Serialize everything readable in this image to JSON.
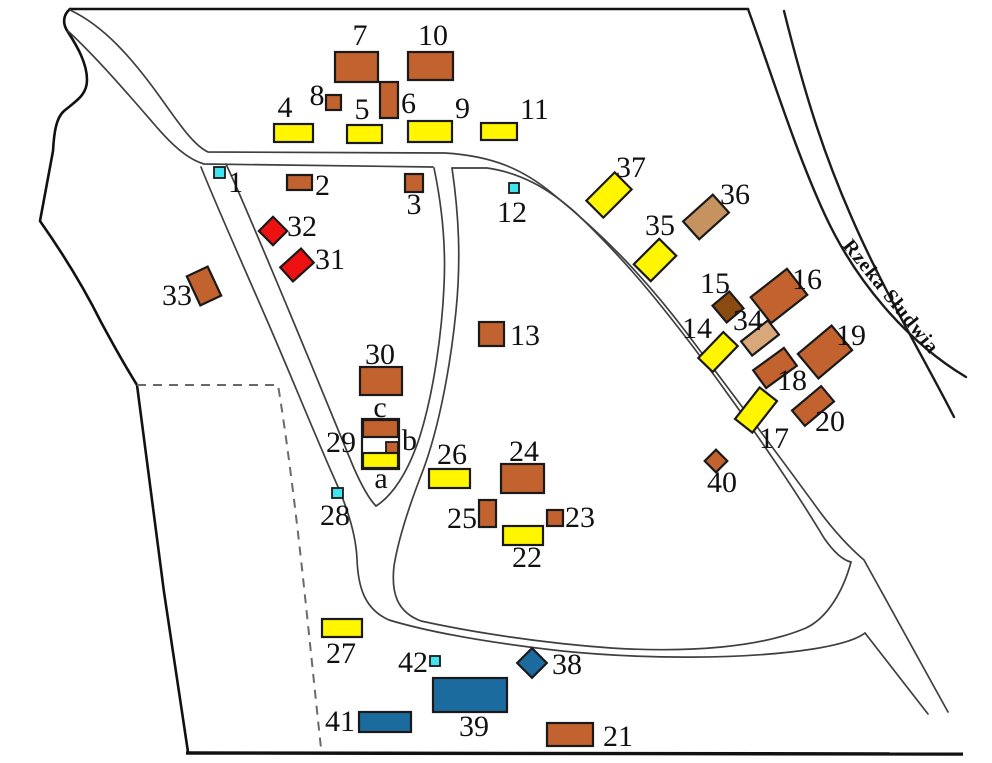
{
  "river": {
    "label": "Rzeka Słudwia"
  },
  "palette": {
    "sienna": "#C1622F",
    "yellow": "#FFF600",
    "red": "#EE1111",
    "tan_dark": "#C6925F",
    "tan_light": "#D9A87A",
    "dark_brown": "#8B4A10",
    "blue": "#1C6B9F",
    "cyan": "#3FE4EE",
    "white": "#FFFFFF",
    "outline": "#1a1a1a",
    "road": "#3f3f3f"
  },
  "buildings": [
    {
      "id": "29-outline",
      "color": "white",
      "cx": 380.5,
      "cy": 444,
      "w": 37,
      "h": 50,
      "rot": 0
    },
    {
      "id": "1",
      "color": "cyan",
      "cx": 219.5,
      "cy": 172.5,
      "w": 11,
      "h": 11,
      "rot": 0
    },
    {
      "id": "2",
      "color": "sienna",
      "cx": 299.5,
      "cy": 182.5,
      "w": 25,
      "h": 15,
      "rot": 0
    },
    {
      "id": "3",
      "color": "sienna",
      "cx": 414,
      "cy": 183,
      "w": 18,
      "h": 18,
      "rot": 0
    },
    {
      "id": "4",
      "color": "yellow",
      "cx": 293.5,
      "cy": 133,
      "w": 39,
      "h": 18,
      "rot": 0
    },
    {
      "id": "5",
      "color": "yellow",
      "cx": 364.5,
      "cy": 134,
      "w": 35,
      "h": 18,
      "rot": 0
    },
    {
      "id": "6",
      "color": "sienna",
      "cx": 389,
      "cy": 100,
      "w": 18,
      "h": 36,
      "rot": 0
    },
    {
      "id": "7",
      "color": "sienna",
      "cx": 356.5,
      "cy": 67,
      "w": 43,
      "h": 30,
      "rot": 0
    },
    {
      "id": "8",
      "color": "sienna",
      "cx": 333.5,
      "cy": 102.5,
      "w": 15,
      "h": 15,
      "rot": 0
    },
    {
      "id": "9",
      "color": "yellow",
      "cx": 430,
      "cy": 131.5,
      "w": 44,
      "h": 21,
      "rot": 0
    },
    {
      "id": "10",
      "color": "sienna",
      "cx": 430.5,
      "cy": 66,
      "w": 45,
      "h": 28,
      "rot": 0
    },
    {
      "id": "11",
      "color": "yellow",
      "cx": 499,
      "cy": 131.5,
      "w": 36,
      "h": 17,
      "rot": 0
    },
    {
      "id": "12",
      "color": "cyan",
      "cx": 514,
      "cy": 188,
      "w": 10,
      "h": 10,
      "rot": 0
    },
    {
      "id": "13",
      "color": "sienna",
      "cx": 491.5,
      "cy": 334,
      "w": 25,
      "h": 24,
      "rot": 0
    },
    {
      "id": "14",
      "color": "yellow",
      "cx": 718,
      "cy": 352,
      "w": 36,
      "h": 20,
      "rot": -46
    },
    {
      "id": "15",
      "color": "dark_brown",
      "cx": 728,
      "cy": 307,
      "w": 22,
      "h": 22,
      "rot": -40
    },
    {
      "id": "16",
      "color": "sienna",
      "cx": 779,
      "cy": 296,
      "w": 46,
      "h": 33,
      "rot": -38
    },
    {
      "id": "17",
      "color": "yellow",
      "cx": 756,
      "cy": 410,
      "w": 40,
      "h": 22,
      "rot": -52
    },
    {
      "id": "18",
      "color": "sienna",
      "cx": 775,
      "cy": 368,
      "w": 38,
      "h": 22,
      "rot": -36
    },
    {
      "id": "19",
      "color": "sienna",
      "cx": 825,
      "cy": 352,
      "w": 44,
      "h": 32,
      "rot": -40
    },
    {
      "id": "20",
      "color": "sienna",
      "cx": 813,
      "cy": 406,
      "w": 38,
      "h": 20,
      "rot": -40
    },
    {
      "id": "21",
      "color": "sienna",
      "cx": 570,
      "cy": 734.5,
      "w": 46,
      "h": 23,
      "rot": 0
    },
    {
      "id": "22",
      "color": "yellow",
      "cx": 523,
      "cy": 535.5,
      "w": 40,
      "h": 19,
      "rot": 0
    },
    {
      "id": "23",
      "color": "sienna",
      "cx": 555,
      "cy": 518,
      "w": 16,
      "h": 16,
      "rot": 0
    },
    {
      "id": "24",
      "color": "sienna",
      "cx": 522.5,
      "cy": 478.5,
      "w": 43,
      "h": 29,
      "rot": 0
    },
    {
      "id": "25",
      "color": "sienna",
      "cx": 487.5,
      "cy": 513.5,
      "w": 17,
      "h": 27,
      "rot": 0
    },
    {
      "id": "26",
      "color": "yellow",
      "cx": 449.5,
      "cy": 478.5,
      "w": 41,
      "h": 19,
      "rot": 0
    },
    {
      "id": "27",
      "color": "yellow",
      "cx": 342,
      "cy": 628,
      "w": 40,
      "h": 18,
      "rot": 0
    },
    {
      "id": "28",
      "color": "cyan",
      "cx": 337.5,
      "cy": 493,
      "w": 11,
      "h": 10,
      "rot": 0
    },
    {
      "id": "29-c",
      "color": "sienna",
      "cx": 380.5,
      "cy": 428.5,
      "w": 35,
      "h": 17,
      "rot": 0
    },
    {
      "id": "29-b",
      "color": "sienna",
      "cx": 392,
      "cy": 447.5,
      "w": 12,
      "h": 11,
      "rot": 0
    },
    {
      "id": "29-a",
      "color": "yellow",
      "cx": 380.5,
      "cy": 460.5,
      "w": 35,
      "h": 15,
      "rot": 0
    },
    {
      "id": "30",
      "color": "sienna",
      "cx": 381,
      "cy": 381,
      "w": 42,
      "h": 28,
      "rot": 0
    },
    {
      "id": "31",
      "color": "red",
      "cx": 297,
      "cy": 265,
      "w": 28,
      "h": 19,
      "rot": -42
    },
    {
      "id": "32",
      "color": "red",
      "cx": 273,
      "cy": 231,
      "w": 20,
      "h": 20,
      "rot": -45
    },
    {
      "id": "33",
      "color": "sienna",
      "cx": 204,
      "cy": 286,
      "w": 23,
      "h": 32,
      "rot": -25
    },
    {
      "id": "34",
      "color": "tan_light",
      "cx": 760,
      "cy": 338,
      "w": 34,
      "h": 18,
      "rot": -38
    },
    {
      "id": "35",
      "color": "yellow",
      "cx": 655,
      "cy": 260,
      "w": 36,
      "h": 24,
      "rot": -45
    },
    {
      "id": "36",
      "color": "tan_dark",
      "cx": 706,
      "cy": 217,
      "w": 40,
      "h": 24,
      "rot": -42
    },
    {
      "id": "37",
      "color": "yellow",
      "cx": 609,
      "cy": 195,
      "w": 40,
      "h": 24,
      "rot": -45
    },
    {
      "id": "38",
      "color": "blue",
      "cx": 532,
      "cy": 663,
      "w": 21,
      "h": 21,
      "rot": -45
    },
    {
      "id": "39",
      "color": "blue",
      "cx": 470,
      "cy": 695,
      "w": 74,
      "h": 34,
      "rot": 0
    },
    {
      "id": "40",
      "color": "sienna",
      "cx": 716,
      "cy": 461,
      "w": 16,
      "h": 16,
      "rot": -45
    },
    {
      "id": "41",
      "color": "blue",
      "cx": 385,
      "cy": 722,
      "w": 52,
      "h": 20,
      "rot": 0
    },
    {
      "id": "42",
      "color": "cyan",
      "cx": 435,
      "cy": 661,
      "w": 10,
      "h": 10,
      "rot": 0
    }
  ],
  "labels": [
    {
      "text": "1",
      "x": 228,
      "y": 192,
      "anchor": "start"
    },
    {
      "text": "2",
      "x": 315,
      "y": 195,
      "anchor": "start"
    },
    {
      "text": "3",
      "x": 414,
      "y": 214,
      "anchor": "middle"
    },
    {
      "text": "4",
      "x": 285,
      "y": 117,
      "anchor": "middle"
    },
    {
      "text": "5",
      "x": 362,
      "y": 119,
      "anchor": "middle"
    },
    {
      "text": "6",
      "x": 401,
      "y": 113,
      "anchor": "start"
    },
    {
      "text": "7",
      "x": 360,
      "y": 45,
      "anchor": "middle"
    },
    {
      "text": "8",
      "x": 317,
      "y": 105,
      "anchor": "middle"
    },
    {
      "text": "9",
      "x": 455,
      "y": 118,
      "anchor": "start"
    },
    {
      "text": "10",
      "x": 433,
      "y": 45,
      "anchor": "middle"
    },
    {
      "text": "11",
      "x": 520,
      "y": 119,
      "anchor": "start"
    },
    {
      "text": "12",
      "x": 512,
      "y": 222,
      "anchor": "middle"
    },
    {
      "text": "13",
      "x": 510,
      "y": 345,
      "anchor": "start"
    },
    {
      "text": "14",
      "x": 682,
      "y": 338,
      "anchor": "start"
    },
    {
      "text": "15",
      "x": 700,
      "y": 293,
      "anchor": "start"
    },
    {
      "text": "16",
      "x": 792,
      "y": 289,
      "anchor": "start"
    },
    {
      "text": "17",
      "x": 774,
      "y": 448,
      "anchor": "middle"
    },
    {
      "text": "18",
      "x": 792,
      "y": 390,
      "anchor": "middle"
    },
    {
      "text": "19",
      "x": 836,
      "y": 345,
      "anchor": "start"
    },
    {
      "text": "20",
      "x": 830,
      "y": 431,
      "anchor": "middle"
    },
    {
      "text": "21",
      "x": 603,
      "y": 746,
      "anchor": "start"
    },
    {
      "text": "22",
      "x": 527,
      "y": 567,
      "anchor": "middle"
    },
    {
      "text": "23",
      "x": 565,
      "y": 527,
      "anchor": "start"
    },
    {
      "text": "24",
      "x": 524,
      "y": 461,
      "anchor": "middle"
    },
    {
      "text": "25",
      "x": 477,
      "y": 528,
      "anchor": "end"
    },
    {
      "text": "26",
      "x": 452,
      "y": 464,
      "anchor": "middle"
    },
    {
      "text": "27",
      "x": 341,
      "y": 663,
      "anchor": "middle"
    },
    {
      "text": "28",
      "x": 335,
      "y": 525,
      "anchor": "middle"
    },
    {
      "text": "29",
      "x": 341,
      "y": 452,
      "anchor": "middle"
    },
    {
      "text": "c",
      "x": 380,
      "y": 417,
      "anchor": "middle"
    },
    {
      "text": "b",
      "x": 402,
      "y": 450,
      "anchor": "start"
    },
    {
      "text": "a",
      "x": 381,
      "y": 488,
      "anchor": "middle"
    },
    {
      "text": "30",
      "x": 380,
      "y": 364,
      "anchor": "middle"
    },
    {
      "text": "31",
      "x": 315,
      "y": 269,
      "anchor": "start"
    },
    {
      "text": "32",
      "x": 287,
      "y": 236,
      "anchor": "start"
    },
    {
      "text": "33",
      "x": 177,
      "y": 305,
      "anchor": "middle"
    },
    {
      "text": "34",
      "x": 748,
      "y": 330,
      "anchor": "middle"
    },
    {
      "text": "35",
      "x": 660,
      "y": 235,
      "anchor": "middle"
    },
    {
      "text": "36",
      "x": 735,
      "y": 204,
      "anchor": "middle"
    },
    {
      "text": "37",
      "x": 631,
      "y": 177,
      "anchor": "middle"
    },
    {
      "text": "38",
      "x": 552,
      "y": 674,
      "anchor": "start"
    },
    {
      "text": "39",
      "x": 474,
      "y": 736,
      "anchor": "middle"
    },
    {
      "text": "40",
      "x": 722,
      "y": 492,
      "anchor": "middle"
    },
    {
      "text": "41",
      "x": 355,
      "y": 731,
      "anchor": "end"
    },
    {
      "text": "42",
      "x": 428,
      "y": 672,
      "anchor": "end"
    }
  ]
}
